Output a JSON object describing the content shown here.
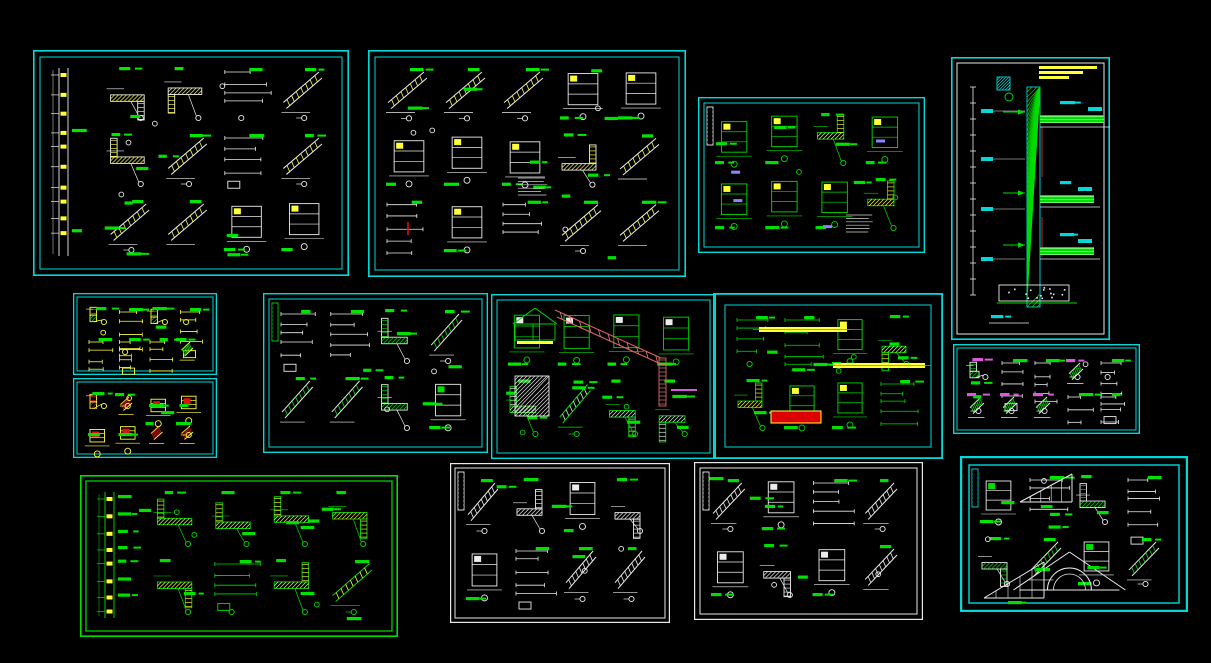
{
  "canvas": {
    "width": 1211,
    "height": 663,
    "background": "#000000"
  },
  "colors": {
    "frame_cyan": "#00d9d9",
    "frame_green": "#00e000",
    "frame_white": "#e8e8e8",
    "line_white": "#ececec",
    "line_green": "#00dd00",
    "hatch_yellow": "#ffff3a",
    "label_green": "#00e800",
    "accent_red": "#e01010",
    "accent_magenta": "#d959d9",
    "accent_purple": "#8787ff",
    "accent_cyan": "#00d9d9"
  },
  "panels": [
    {
      "name": "wall-section-details-sheet-1",
      "x": 33,
      "y": 50,
      "w": 316,
      "h": 226,
      "seed": 101,
      "border": {
        "color": "#00d9d9",
        "outerW": 1.6,
        "innerGap": 7,
        "innerW": 1
      },
      "cell": [
        60,
        70
      ],
      "palette": {
        "primary": "#ececec",
        "secondary": "#ffff3a",
        "label": "#00e800"
      },
      "features": [
        {
          "type": "left-wall-columns"
        }
      ]
    },
    {
      "name": "eave-and-parapet-details-sheet-2",
      "x": 368,
      "y": 50,
      "w": 318,
      "h": 227,
      "seed": 102,
      "border": {
        "color": "#00d9d9",
        "outerW": 1.6,
        "innerGap": 7,
        "innerW": 1
      },
      "cell": [
        60,
        70
      ],
      "palette": {
        "primary": "#ececec",
        "secondary": "#ffff3a",
        "label": "#00e800"
      },
      "features": [
        {
          "type": "red-tick",
          "x": 40,
          "y": 172
        },
        {
          "type": "note-lines",
          "x": 150,
          "y": 128
        }
      ]
    },
    {
      "name": "window-jamb-details-sheet-3",
      "x": 698,
      "y": 97,
      "w": 227,
      "h": 156,
      "seed": 103,
      "border": {
        "color": "#00d9d9",
        "outerW": 1.4,
        "innerGap": 6,
        "innerW": 1
      },
      "cell": [
        52,
        60
      ],
      "palette": {
        "primary": "#00dd00",
        "secondary": "#ffff3a",
        "label": "#ececec"
      },
      "features": [
        {
          "type": "legend-strip",
          "color": "#ececec"
        },
        {
          "type": "purple-blobs"
        },
        {
          "type": "note-lines",
          "x": 148,
          "y": 118
        }
      ]
    },
    {
      "name": "tall-wall-section-sheet-4",
      "x": 951,
      "y": 57,
      "w": 159,
      "h": 283,
      "seed": 104,
      "border": {
        "color": "#00d9d9",
        "outerW": 1.6,
        "innerGap": 6,
        "innerW": 1,
        "innerColor": "#e8e8e8"
      },
      "cell": [
        60,
        70
      ],
      "palette": {
        "primary": "#00dd00",
        "secondary": "#00dd00",
        "label": "#00d9d9"
      },
      "features": [
        {
          "type": "tall-wall"
        }
      ]
    },
    {
      "name": "small-node-details-sheet-5",
      "x": 73,
      "y": 293,
      "w": 144,
      "h": 82,
      "seed": 105,
      "border": {
        "color": "#00d9d9",
        "outerW": 1.3,
        "innerGap": 4,
        "innerW": 1
      },
      "cell": [
        34,
        34
      ],
      "palette": {
        "primary": "#ffff3a",
        "secondary": "#00dd00",
        "label": "#ececec"
      },
      "features": []
    },
    {
      "name": "small-node-details-sheet-6",
      "x": 73,
      "y": 378,
      "w": 144,
      "h": 80,
      "seed": 106,
      "border": {
        "color": "#00d9d9",
        "outerW": 1.3,
        "innerGap": 4,
        "innerW": 1
      },
      "cell": [
        34,
        34
      ],
      "palette": {
        "primary": "#ffff3a",
        "secondary": "#e01010",
        "label": "#ececec"
      },
      "features": []
    },
    {
      "name": "stair-and-railing-details-sheet-7",
      "x": 263,
      "y": 293,
      "w": 225,
      "h": 160,
      "seed": 107,
      "border": {
        "color": "#00d9d9",
        "outerW": 1.4,
        "innerGap": 6,
        "innerW": 1
      },
      "cell": [
        54,
        64
      ],
      "palette": {
        "primary": "#ececec",
        "secondary": "#00dd00",
        "label": "#00e800"
      },
      "features": [
        {
          "type": "legend-strip",
          "color": "#00dd00"
        }
      ]
    },
    {
      "name": "roof-slope-details-sheet-8",
      "x": 491,
      "y": 294,
      "w": 225,
      "h": 165,
      "seed": 108,
      "border": {
        "color": "#00d9d9",
        "outerW": 1.4,
        "innerGap": 6,
        "innerW": 1
      },
      "cell": [
        52,
        66
      ],
      "palette": {
        "primary": "#00dd00",
        "secondary": "#ececec",
        "label": "#00e800"
      },
      "features": [
        {
          "type": "red-slope"
        },
        {
          "type": "gable"
        },
        {
          "type": "hatch-square",
          "x": 24,
          "y": 82
        },
        {
          "type": "magenta-bar",
          "x": 180,
          "y": 96
        }
      ]
    },
    {
      "name": "beam-node-details-sheet-9",
      "x": 713,
      "y": 293,
      "w": 230,
      "h": 166,
      "seed": 109,
      "border": {
        "color": "#00d9d9",
        "outerW": 1.8,
        "innerGap": 12,
        "innerW": 1
      },
      "cell": [
        54,
        64
      ],
      "palette": {
        "primary": "#00dd00",
        "secondary": "#ffff3a",
        "label": "#ececec"
      },
      "features": [
        {
          "type": "yellow-bars"
        },
        {
          "type": "red-rect",
          "x": 58,
          "y": 118
        }
      ]
    },
    {
      "name": "column-details-sheet-10",
      "x": 953,
      "y": 344,
      "w": 187,
      "h": 90,
      "seed": 110,
      "border": {
        "color": "#00d9d9",
        "outerW": 1.4,
        "innerGap": 4,
        "innerW": 1
      },
      "cell": [
        36,
        36
      ],
      "palette": {
        "primary": "#ececec",
        "secondary": "#00dd00",
        "label": "#d959d9"
      },
      "features": []
    },
    {
      "name": "green-wall-details-sheet-11",
      "x": 80,
      "y": 475,
      "w": 318,
      "h": 162,
      "seed": 111,
      "border": {
        "color": "#00e000",
        "outerW": 1.6,
        "innerGap": 6,
        "innerW": 1.2
      },
      "cell": [
        56,
        68
      ],
      "palette": {
        "primary": "#00dd00",
        "secondary": "#ffff3a",
        "label": "#ececec"
      },
      "features": [
        {
          "type": "left-wall-columns"
        }
      ]
    },
    {
      "name": "white-construction-details-sheet-12",
      "x": 450,
      "y": 463,
      "w": 220,
      "h": 160,
      "seed": 112,
      "border": {
        "color": "#e8e8e8",
        "outerW": 1.2,
        "innerGap": 5,
        "innerW": 1
      },
      "cell": [
        54,
        68
      ],
      "palette": {
        "primary": "#ececec",
        "secondary": "#ececec",
        "label": "#00dd00"
      },
      "features": [
        {
          "type": "legend-strip",
          "color": "#ececec"
        }
      ]
    },
    {
      "name": "white-node-details-sheet-13",
      "x": 694,
      "y": 462,
      "w": 229,
      "h": 158,
      "seed": 113,
      "border": {
        "color": "#e8e8e8",
        "outerW": 1.2,
        "innerGap": 6,
        "innerW": 1
      },
      "cell": [
        50,
        64
      ],
      "palette": {
        "primary": "#ececec",
        "secondary": "#ececec",
        "label": "#00dd00"
      },
      "features": [
        {
          "type": "legend-strip",
          "color": "#ececec"
        }
      ]
    },
    {
      "name": "gable-pediment-details-sheet-14",
      "x": 960,
      "y": 456,
      "w": 228,
      "h": 156,
      "seed": 114,
      "border": {
        "color": "#00d9d9",
        "outerW": 2.2,
        "innerGap": 9,
        "innerW": 1.4
      },
      "cell": [
        52,
        62
      ],
      "palette": {
        "primary": "#ececec",
        "secondary": "#00dd00",
        "label": "#00e800"
      },
      "features": [
        {
          "type": "legend-strip",
          "color": "#00d9d9"
        },
        {
          "type": "pediment"
        },
        {
          "type": "big-triangle",
          "x": 60,
          "y": 18,
          "w": 52,
          "h": 28
        },
        {
          "type": "big-triangle",
          "x": 24,
          "y": 106,
          "w": 60,
          "h": 36
        }
      ]
    }
  ]
}
